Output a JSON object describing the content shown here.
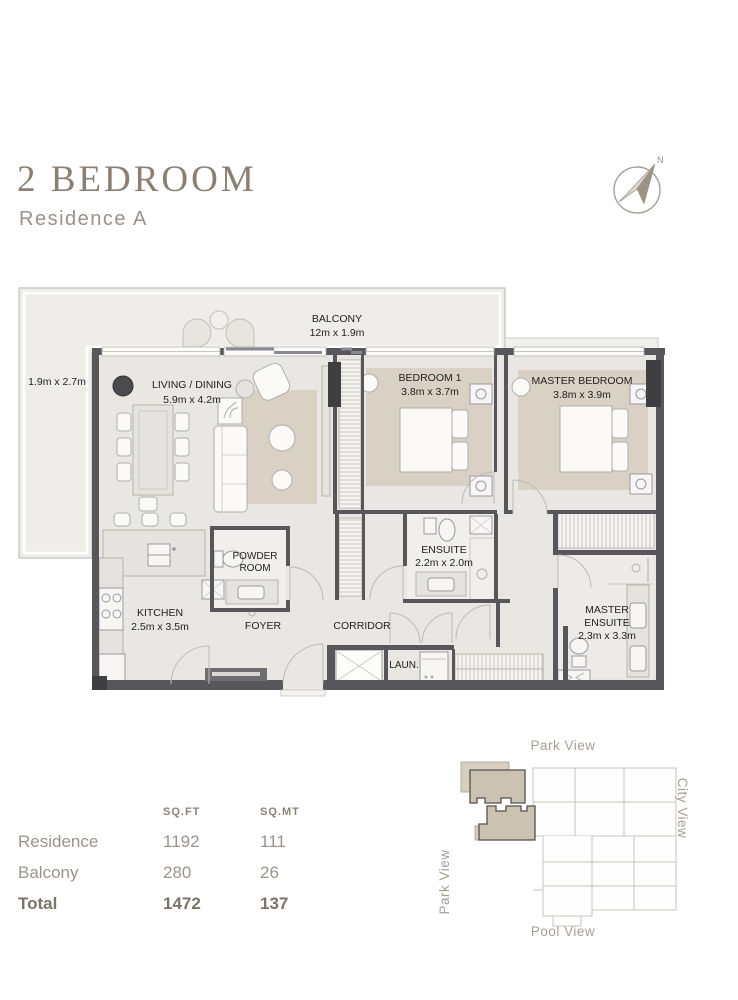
{
  "header": {
    "title": "2 BEDROOM",
    "subtitle": "Residence A",
    "compass_north_label": "N"
  },
  "floorplan": {
    "balcony": {
      "name": "BALCONY",
      "dims": "12m x 1.9m"
    },
    "balcony_side": {
      "dims": "1.9m x 2.7m"
    },
    "living_dining": {
      "name": "LIVING / DINING",
      "dims": "5.9m x 4.2m"
    },
    "bedroom_1": {
      "name": "BEDROOM 1",
      "dims": "3.8m x 3.7m"
    },
    "master_bedroom": {
      "name": "MASTER BEDROOM",
      "dims": "3.8m x 3.9m"
    },
    "powder_room": {
      "line1": "POWDER",
      "line2": "ROOM"
    },
    "ensuite": {
      "name": "ENSUITE",
      "dims": "2.2m x 2.0m"
    },
    "kitchen": {
      "name": "KITCHEN",
      "dims": "2.5m x 3.5m"
    },
    "foyer": {
      "name": "FOYER"
    },
    "corridor": {
      "name": "CORRIDOR"
    },
    "master_ensuite": {
      "line1": "MASTER",
      "line2": "ENSUITE",
      "dims": "2.3m x 3.3m"
    },
    "laundry": {
      "name": "LAUN."
    }
  },
  "area_table": {
    "col_sqft": "SQ.FT",
    "col_sqmt": "SQ.MT",
    "rows": [
      {
        "label": "Residence",
        "sqft": "1192",
        "sqmt": "111"
      },
      {
        "label": "Balcony",
        "sqft": "280",
        "sqmt": "26"
      },
      {
        "label": "Total",
        "sqft": "1472",
        "sqmt": "137"
      }
    ]
  },
  "key_plan": {
    "top_label": "Park View",
    "left_label": "Park View",
    "right_label": "City View",
    "bottom_label": "Pool View"
  },
  "colors": {
    "title": "#8a7f74",
    "muted_text": "#99918a",
    "floor": "#e9e7e3",
    "balcony_floor": "#eeede9",
    "wall": "#57575b",
    "rug": "#d8d1c4",
    "key_highlight": "#cbc2b2"
  }
}
